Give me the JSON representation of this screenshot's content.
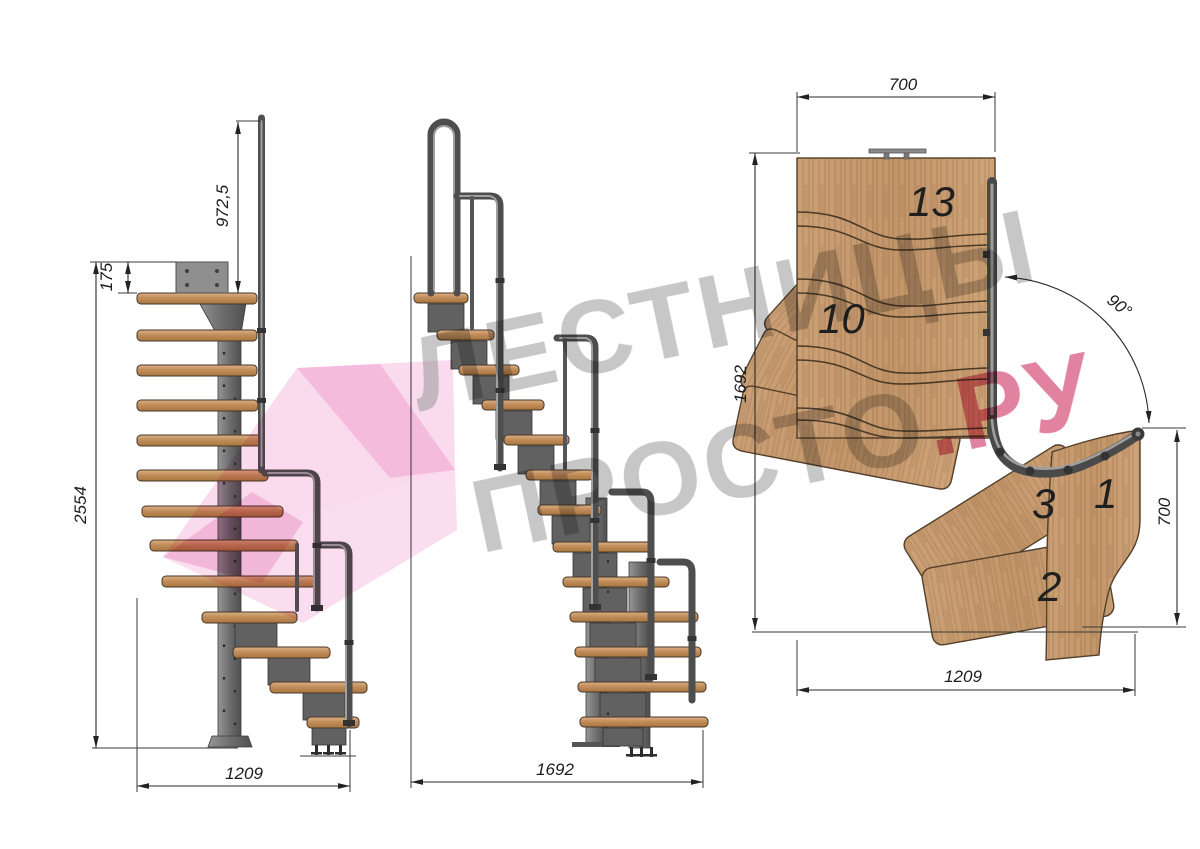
{
  "watermark": {
    "line1": "ЛЕСТНИЦЫ",
    "line2_grey": "ПРОСТО",
    "line2_accent": ".РУ",
    "text_color": "#8f8f8f",
    "accent_color": "#cf2f63",
    "logo_color": "#f2a9d4",
    "logo_color_dark": "#ec93c8"
  },
  "front_view": {
    "dim_handrail_height": "972,5",
    "dim_floor_thickness": "175",
    "dim_total_height": "2554",
    "dim_width": "1209"
  },
  "side_view": {
    "dim_length": "1692"
  },
  "plan_view": {
    "dim_top_width": "700",
    "dim_side_length": "1692",
    "dim_turn_angle": "90°",
    "dim_right_width": "700",
    "dim_bottom_length": "1209",
    "label_step_13": "13",
    "label_step_10": "10",
    "label_step_3": "3",
    "label_step_1": "1",
    "label_step_2": "2"
  },
  "colors": {
    "background": "#ffffff",
    "wood": "#c59a6c",
    "wood_dark": "#a87e52",
    "steel": "#6e6e6e",
    "rail": "#4e4e4e",
    "dimension_ink": "#2a2a2a"
  }
}
